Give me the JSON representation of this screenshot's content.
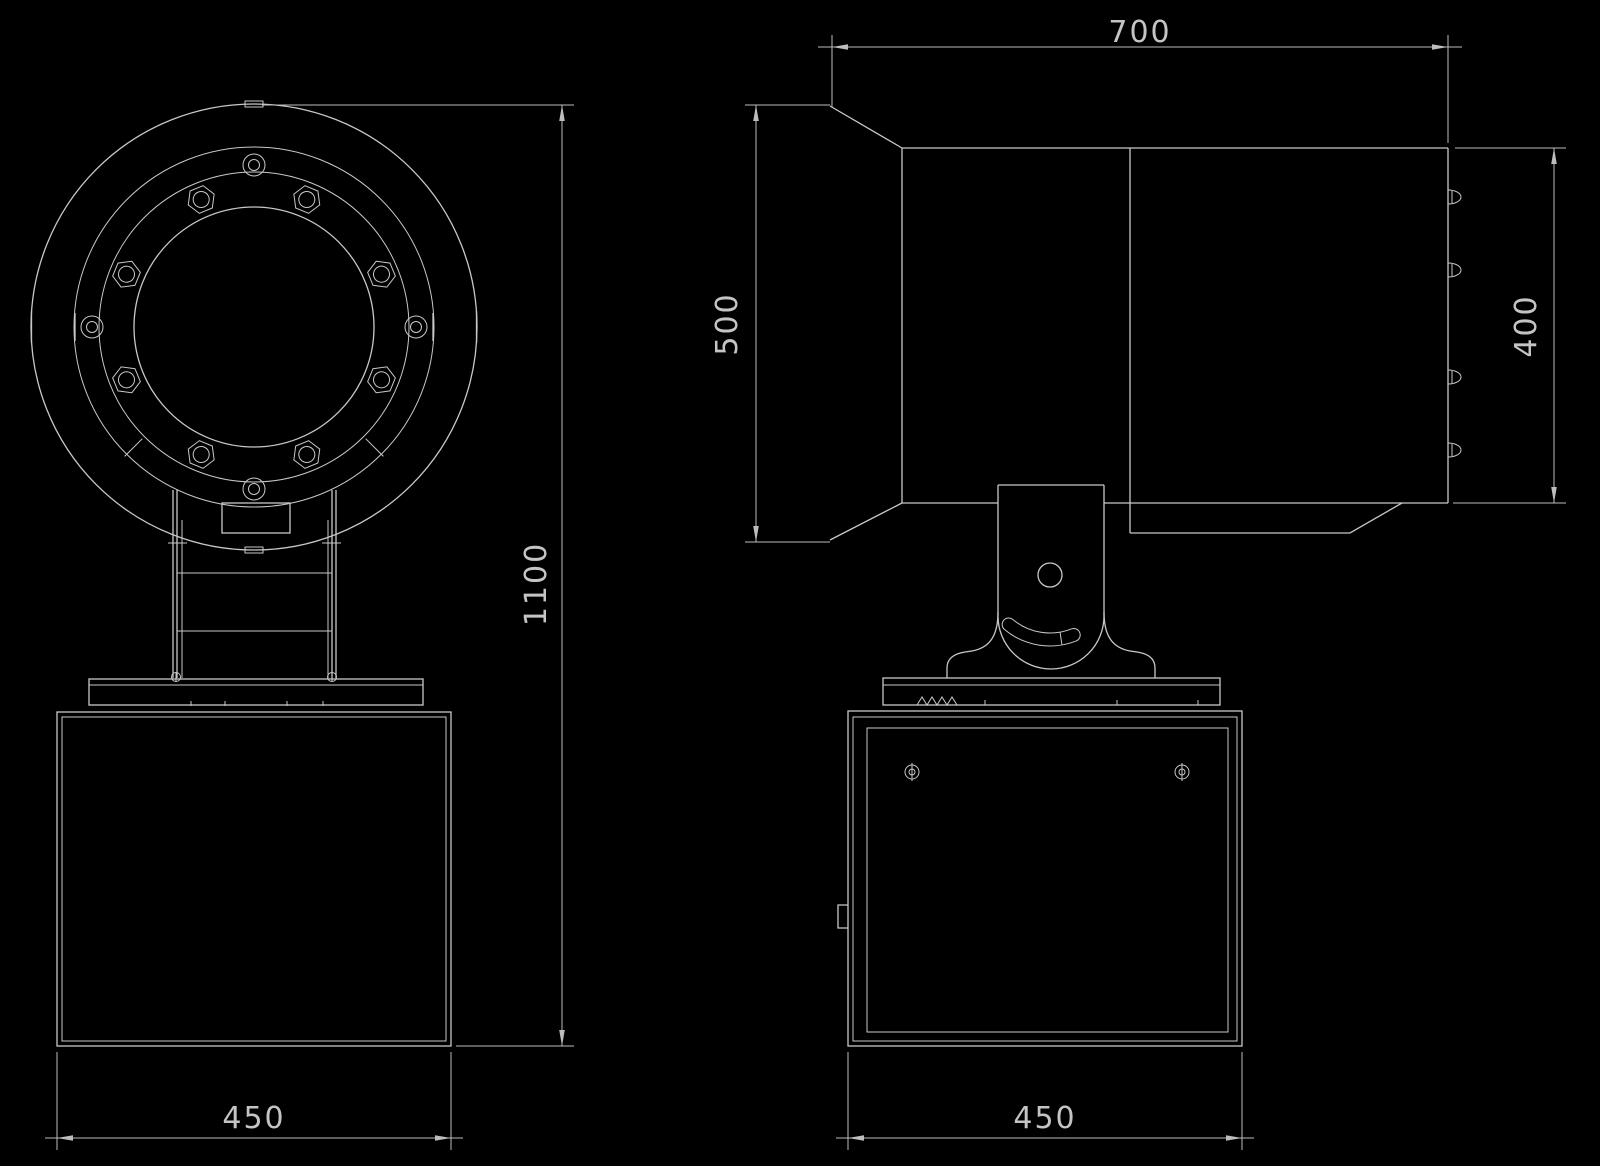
{
  "theme": {
    "background": "#000000",
    "line_color": "#c8c8c8",
    "dim_line_color": "#bdbdbd",
    "dim_text_color": "#c4c4c4"
  },
  "drawing": {
    "kind": "technical-outline-drawing",
    "views": {
      "front": {
        "name": "front view (searchlight head, yoke column and pedestal box)"
      },
      "side": {
        "name": "side view (lamp housing, trunnion bracket and pedestal box)"
      }
    },
    "dimensions": {
      "housing_width": {
        "value": "700",
        "rotated": false,
        "view": "side"
      },
      "front_height": {
        "value": "500",
        "rotated": true,
        "view": "side"
      },
      "rear_height": {
        "value": "400",
        "rotated": true,
        "view": "side"
      },
      "total_height": {
        "value": "1100",
        "rotated": true,
        "view": "front"
      },
      "base_width_front": {
        "value": "450",
        "rotated": false,
        "view": "front"
      },
      "base_width_side": {
        "value": "450",
        "rotated": false,
        "view": "side"
      }
    }
  }
}
